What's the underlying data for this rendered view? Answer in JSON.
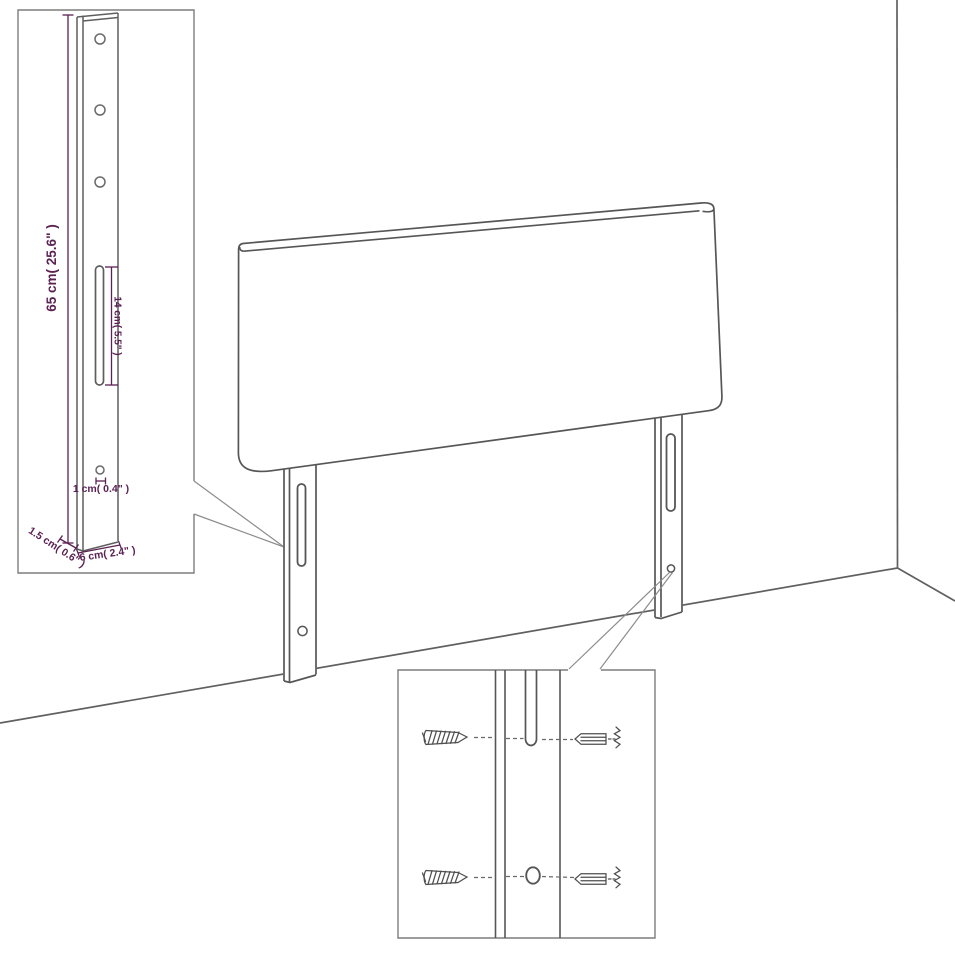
{
  "page": {
    "background_color": "#ffffff"
  },
  "colors": {
    "drawing_line": "#565656",
    "inset_border": "#7d7d7d",
    "callout_line": "#8c8c8c",
    "dimension_accent": "#5b2153"
  },
  "dimension_labels": {
    "leg_height": "65 cm( 25.6\" )",
    "slot_length": "14 cm( 5.5\" )",
    "hole_diameter": "1 cm( 0.4\" )",
    "leg_thickness": "1.5 cm( 0.6\" )",
    "leg_width": "6 cm( 2.4\" )"
  }
}
